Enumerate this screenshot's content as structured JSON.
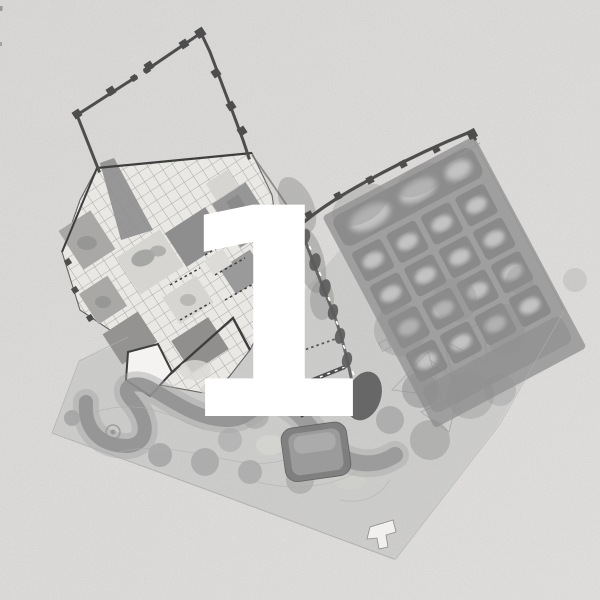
{
  "figure": {
    "label": "1"
  },
  "colors": {
    "paper": "#e4e3e1",
    "paper_light": "#eceae8",
    "paper_dark": "#dbdad8",
    "ink": "#3e3e3e",
    "wall": "#4d4d4d",
    "plate": "#eae8e5",
    "court_dark": "#8e8e8e",
    "court_mid": "#a9a8a6",
    "court_light": "#d6d5d2",
    "garden": "#9b9b9b",
    "plot": "#8a8a8a",
    "plot_center": "#c3c3c3",
    "wash": "#c0c0c0",
    "canopy": "#8f8f8f",
    "canopy_dark": "#5c5c5c",
    "canopy_halo": "#a6a6a6",
    "path": "#aeaead",
    "pool_rim": "#7d7d7d",
    "pool_fill": "#9b9b9b",
    "building_white": "#f4f3f1",
    "numeral": "#ffffff"
  }
}
